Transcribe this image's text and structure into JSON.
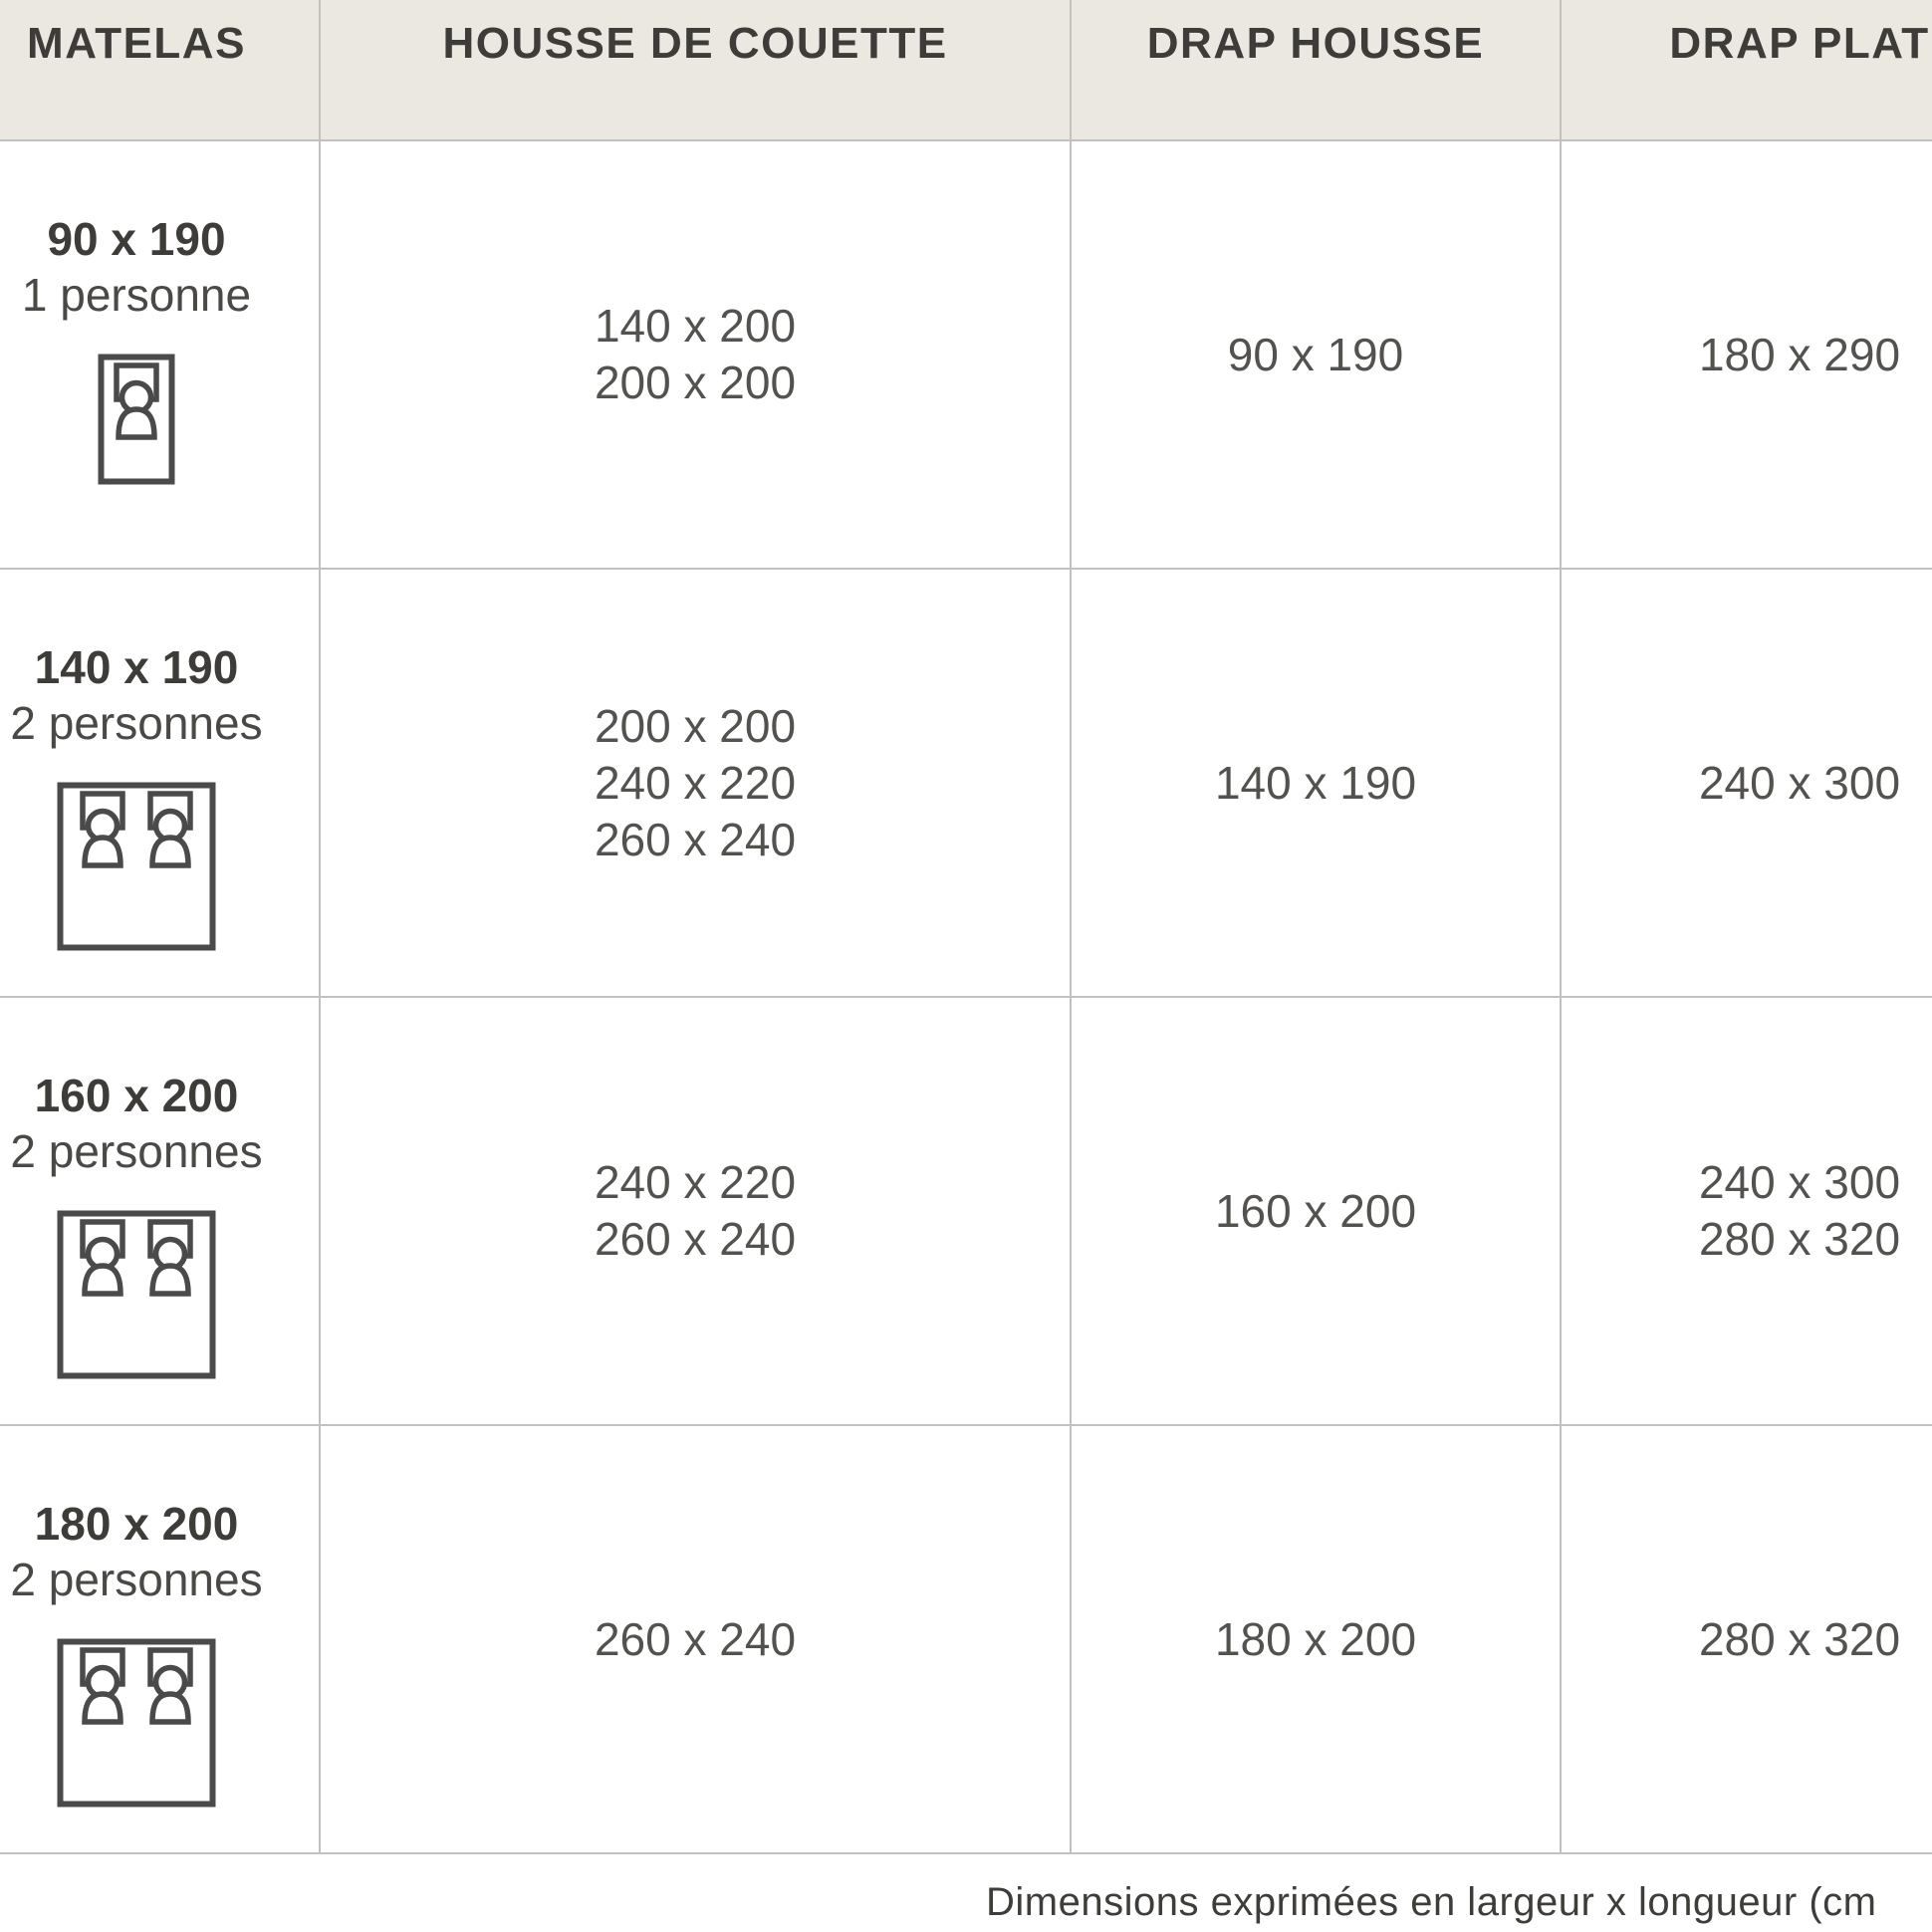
{
  "table": {
    "columns": [
      {
        "key": "matelas",
        "label": "MATELAS"
      },
      {
        "key": "housse_de_couette",
        "label": "HOUSSE DE COUETTE"
      },
      {
        "key": "drap_housse",
        "label": "DRAP HOUSSE"
      },
      {
        "key": "drap_plat",
        "label": "DRAP PLAT"
      }
    ],
    "rows": [
      {
        "matelas_size": "90 x 190",
        "capacity": "1 personne",
        "bed_icon": "single-bed-icon",
        "housse_de_couette": [
          "140 x 200",
          "200 x 200"
        ],
        "drap_housse": [
          "90 x 190"
        ],
        "drap_plat": [
          "180 x 290"
        ]
      },
      {
        "matelas_size": "140 x 190",
        "capacity": "2 personnes",
        "bed_icon": "double-bed-icon",
        "housse_de_couette": [
          "200 x 200",
          "240 x 220",
          "260 x 240"
        ],
        "drap_housse": [
          "140 x 190"
        ],
        "drap_plat": [
          "240 x 300"
        ]
      },
      {
        "matelas_size": "160 x 200",
        "capacity": "2 personnes",
        "bed_icon": "double-bed-icon",
        "housse_de_couette": [
          "240 x 220",
          "260 x 240"
        ],
        "drap_housse": [
          "160 x 200"
        ],
        "drap_plat": [
          "240 x 300",
          "280 x 320"
        ]
      },
      {
        "matelas_size": "180 x 200",
        "capacity": "2 personnes",
        "bed_icon": "double-bed-icon",
        "housse_de_couette": [
          "260 x 240"
        ],
        "drap_housse": [
          "180 x 200"
        ],
        "drap_plat": [
          "280 x 320"
        ]
      }
    ]
  },
  "footer": {
    "note": "Dimensions exprimées en largeur x longueur (cm"
  },
  "colors": {
    "header_background": "#EBE7E1",
    "grid_line": "#C3C1BD",
    "heading_text": "#3E3C39",
    "value_text": "#54524F",
    "icon_stroke": "#4A4A4A"
  }
}
